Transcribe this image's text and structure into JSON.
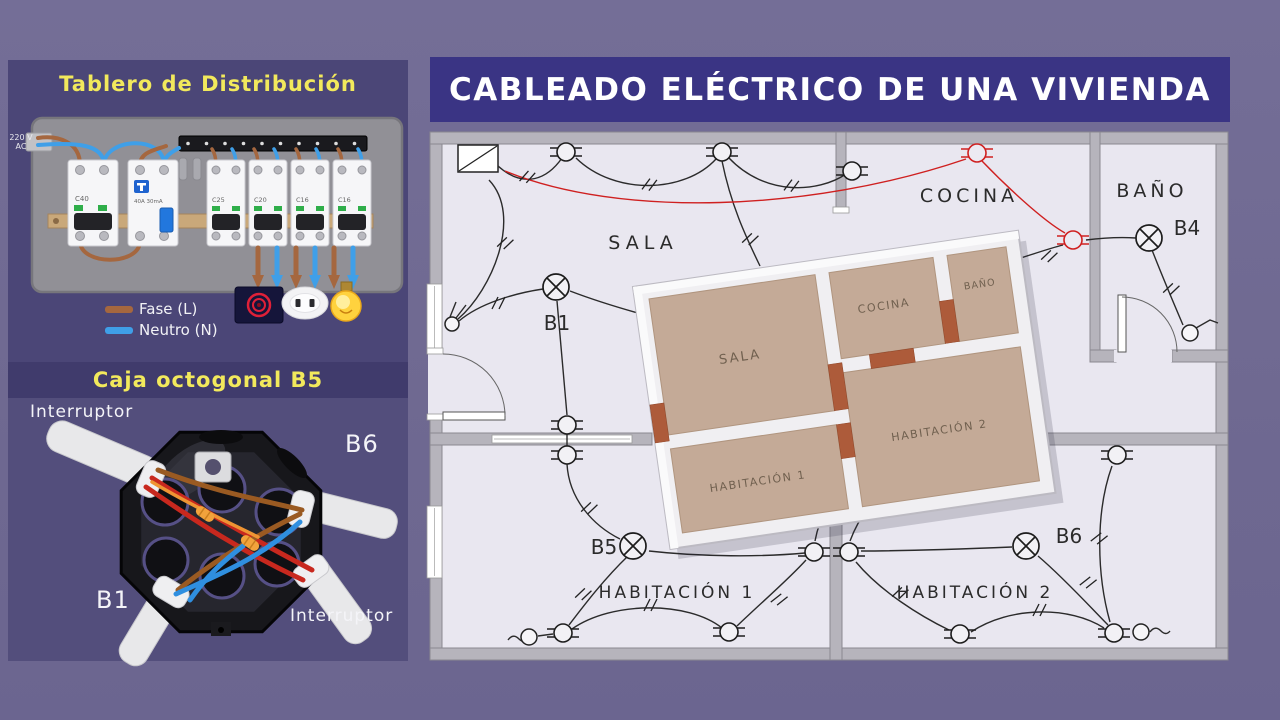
{
  "banner": {
    "title": "CABLEADO ELÉCTRICO DE UNA VIVIENDA"
  },
  "tablero": {
    "title": "Tablero de Distribución",
    "supply": {
      "line1": "220 V",
      "line2": "AC"
    },
    "breakers": {
      "main": "C40",
      "rcd_amp": "40A 30mA",
      "mcb1": "C25",
      "mcb2": "C20",
      "mcb3": "C16",
      "mcb4": "C16"
    },
    "legend": {
      "fase": "Fase (L)",
      "neutro": "Neutro (N)"
    },
    "colors": {
      "fase": "#a5673f",
      "neutro": "#3f9fe8"
    }
  },
  "caja": {
    "title": "Caja octogonal B5",
    "labels": {
      "top_left": "Interruptor",
      "right": "B6",
      "bottom_left": "B1",
      "bottom_right": "Interruptor"
    }
  },
  "plan": {
    "rooms": {
      "sala": "SALA",
      "cocina": "COCINA",
      "bano": "BAÑO",
      "hab1": "HABITACIÓN 1",
      "hab2": "HABITACIÓN 2"
    },
    "lamps": {
      "b1": "B1",
      "b4": "B4",
      "b5": "B5",
      "b6": "B6"
    }
  },
  "model": {
    "rooms": {
      "sala": "SALA",
      "cocina": "COCINA",
      "bano": "BAÑO",
      "hab1": "HABITACIÓN 1",
      "hab2": "HABITACIÓN 2"
    }
  }
}
